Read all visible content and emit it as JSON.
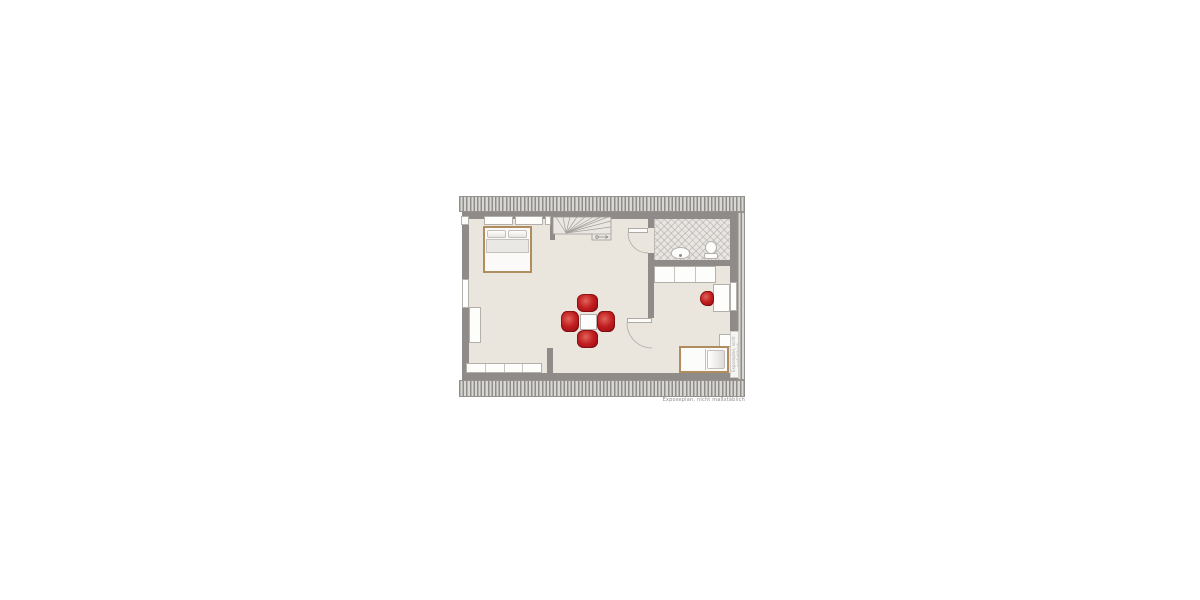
{
  "plan": {
    "watermark_text": "Exposeplan, nicht maßstäblich",
    "side_watermark_text": "Exposeplan, nicht maßstäblich"
  },
  "colors": {
    "floor": "#eae5dd",
    "wall": "#8e8b88",
    "hatch_dark": "#8f8d8a",
    "hatch_light": "#d9d7d4",
    "tile_floor": "#e8e5e2",
    "accent_red": "#b5161c",
    "wood": "#b08d5f",
    "furniture_white": "#fdfdfc"
  },
  "furniture_icons": [
    "double-bed",
    "winder-staircase",
    "dining-table",
    "upholstered-chair",
    "sideboard",
    "cabinet",
    "wardrobe",
    "bathroom-sink",
    "toilet",
    "desk",
    "desk-chair",
    "single-bed",
    "nightstand",
    "window",
    "door"
  ]
}
